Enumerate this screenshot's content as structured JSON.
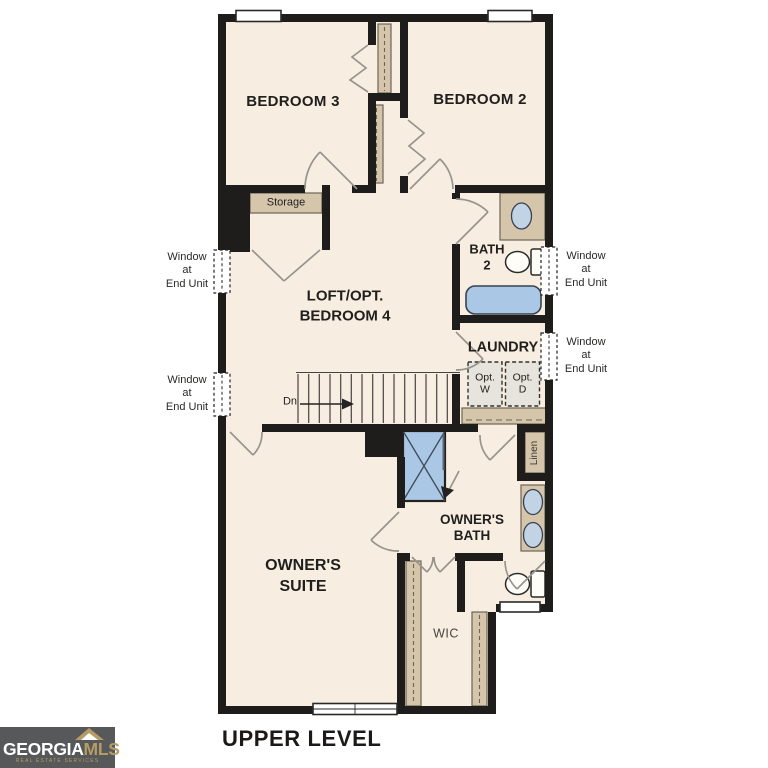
{
  "plan": {
    "title": "UPPER LEVEL",
    "rooms": {
      "bedroom3": "BEDROOM 3",
      "bedroom2": "BEDROOM 2",
      "loft": "LOFT/OPT.\nBEDROOM 4",
      "bath2": "BATH\n2",
      "laundry": "LAUNDRY",
      "owners_suite": "OWNER'S\nSUITE",
      "owners_bath": "OWNER'S\nBATH",
      "wic": "WIC",
      "storage": "Storage",
      "linen": "Linen"
    },
    "notes": {
      "window_end_unit": "Window\nat\nEnd Unit",
      "stair_direction": "Dn",
      "opt_washer": "Opt.\nW",
      "opt_dryer": "Opt.\nD"
    }
  },
  "logo": {
    "brand": "GEORGIA",
    "brand_suffix": "MLS",
    "tagline": "REAL ESTATE SERVICES"
  },
  "colors": {
    "wall": "#1e1d1b",
    "floor": "#f7eee1",
    "tan": "#d5c5aa",
    "tan_border": "#6b6557",
    "blue": "#aac8e5",
    "text": "#201f1d",
    "door": "#98948c",
    "logo_bg": "#57585a",
    "logo_gold": "#b59c66"
  }
}
